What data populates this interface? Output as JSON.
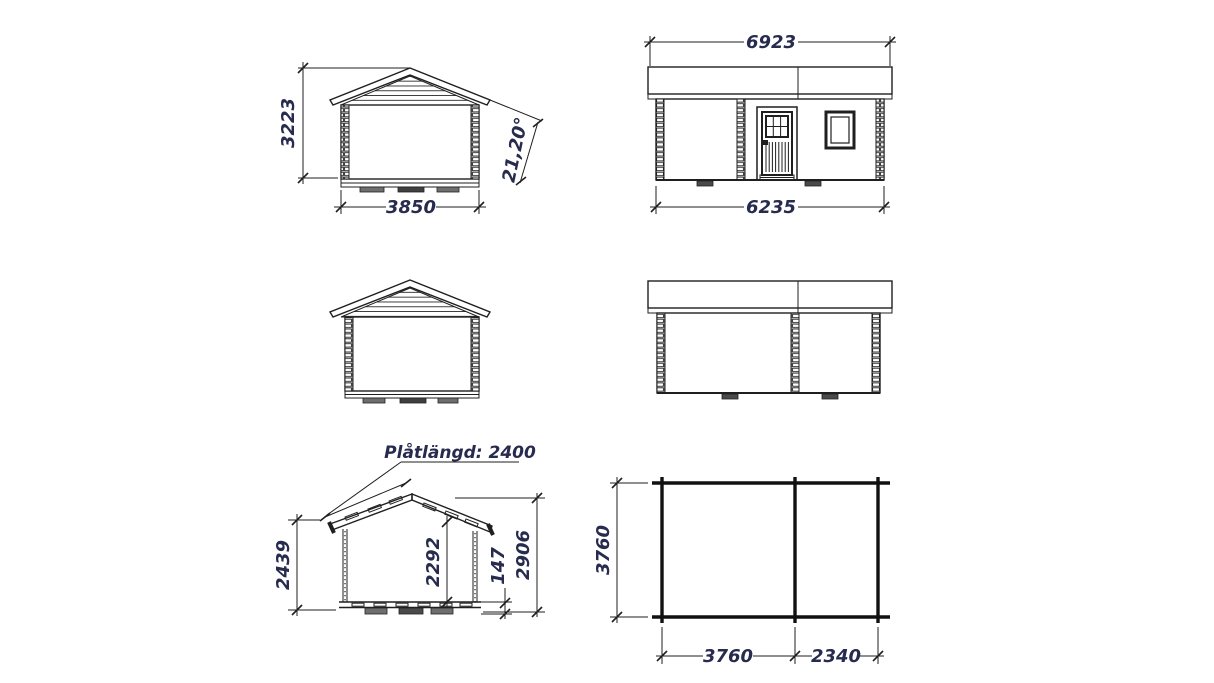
{
  "page": {
    "background": "#ffffff"
  },
  "colors": {
    "line": "#1f1f1f",
    "dimension_text": "#272b4e",
    "foundation_block": "#6e6e6e",
    "foundation_block_dark": "#3f3f3f"
  },
  "views": {
    "front_gable_elevation": {
      "dim_height": "3223",
      "dim_width": "3850",
      "dim_roof_angle": "21,20°"
    },
    "side_elevation_front": {
      "dim_roof_length": "6923",
      "dim_wall_length": "6235"
    },
    "cross_section": {
      "plate_length_label": "Plåtlängd: 2400",
      "dim_wall_height": "2439",
      "dim_interior_height": "2292",
      "dim_floor_height": "147",
      "dim_total_height": "2906"
    },
    "floor_plan": {
      "dim_depth": "3760",
      "dim_room_a_width": "3760",
      "dim_room_b_width": "2340"
    }
  }
}
